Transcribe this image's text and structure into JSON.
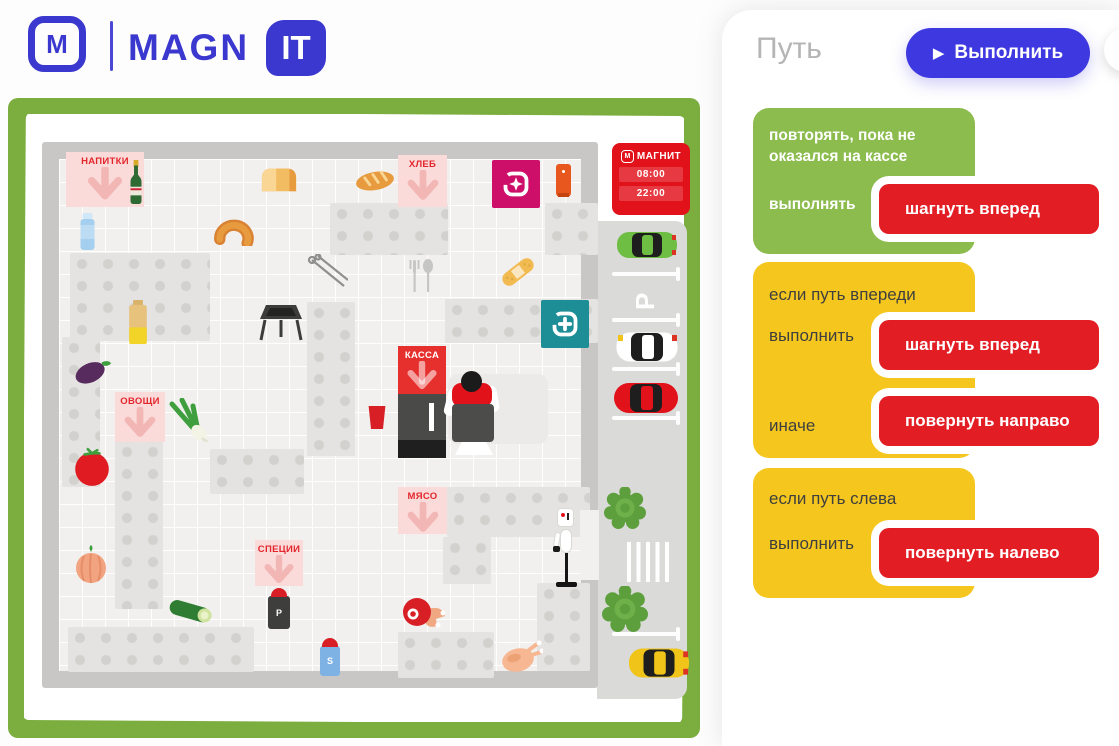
{
  "brand": {
    "logo_m": "М",
    "magn": "MAGN",
    "it": "IT"
  },
  "icons": {
    "play": "▶"
  },
  "panel": {
    "title": "Путь",
    "run_label": "Выполнить",
    "blocks": [
      {
        "condition": "повторять, пока не оказался на кассе",
        "do_label": "выполнять",
        "command": "шагнуть вперед"
      },
      {
        "condition": "если путь впереди",
        "do_label": "выполнить",
        "command": "шагнуть вперед",
        "else_label": "иначе",
        "else_command": "повернуть направо"
      },
      {
        "condition": "если путь слева",
        "do_label": "выполнить",
        "command": "повернуть налево"
      }
    ]
  },
  "map": {
    "store_sign": {
      "logo_letter": "М",
      "brand": "МАГНИТ",
      "open_time": "08:00",
      "close_time": "22:00"
    },
    "section_labels": {
      "drinks": "НАПИТКИ",
      "bread": "ХЛЕБ",
      "vegetables": "ОВОЩИ",
      "checkout": "КАССА",
      "meat": "МЯСО",
      "spices": "СПЕЦИИ"
    },
    "parking_letter": "P",
    "pepper_letter": "P",
    "salt_letter": "S"
  },
  "colors": {
    "accent_blue": "#3b38cf",
    "run_blue": "#3e38e0",
    "magnit_red": "#e2121b",
    "block_green": "#8bbc4d",
    "block_yellow": "#f5c71e",
    "block_red": "#e21d24",
    "frame_green": "#7cae3f",
    "cosmetic_magenta": "#ce0f69",
    "pharmacy_teal": "#1d8e96"
  }
}
